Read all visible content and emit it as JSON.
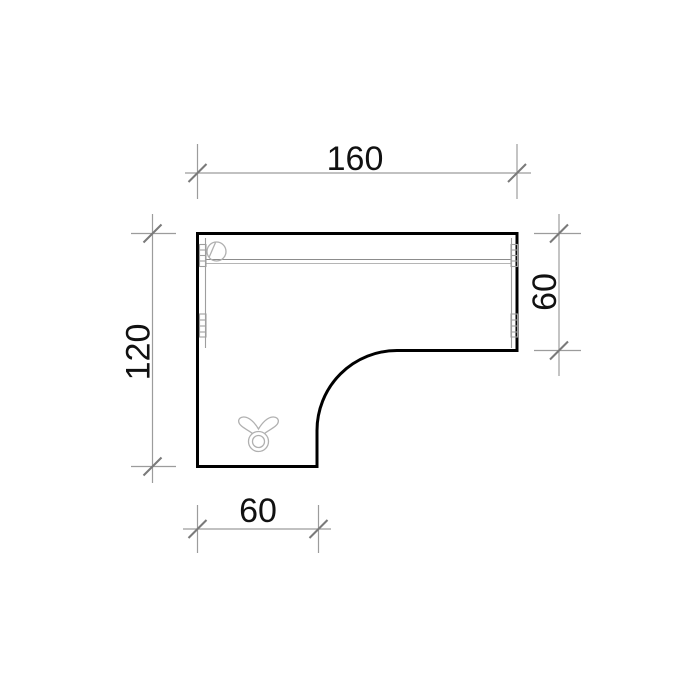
{
  "drawing": {
    "dims": {
      "top": "160",
      "right": "60",
      "bottom": "60",
      "left": "120"
    },
    "colors": {
      "outline": "#000000",
      "dimension_lines": "#9c9c9c",
      "tick_marks": "#7a7a7a",
      "detail_lines": "#9e9e9e",
      "label_text": "#111111",
      "background": "#ffffff"
    },
    "icons": {
      "top_left_circle": "cable-grommet-icon",
      "edge_fittings": "leg-bracket-icon",
      "lower_left_symbol": "castor-glide-icon"
    }
  }
}
